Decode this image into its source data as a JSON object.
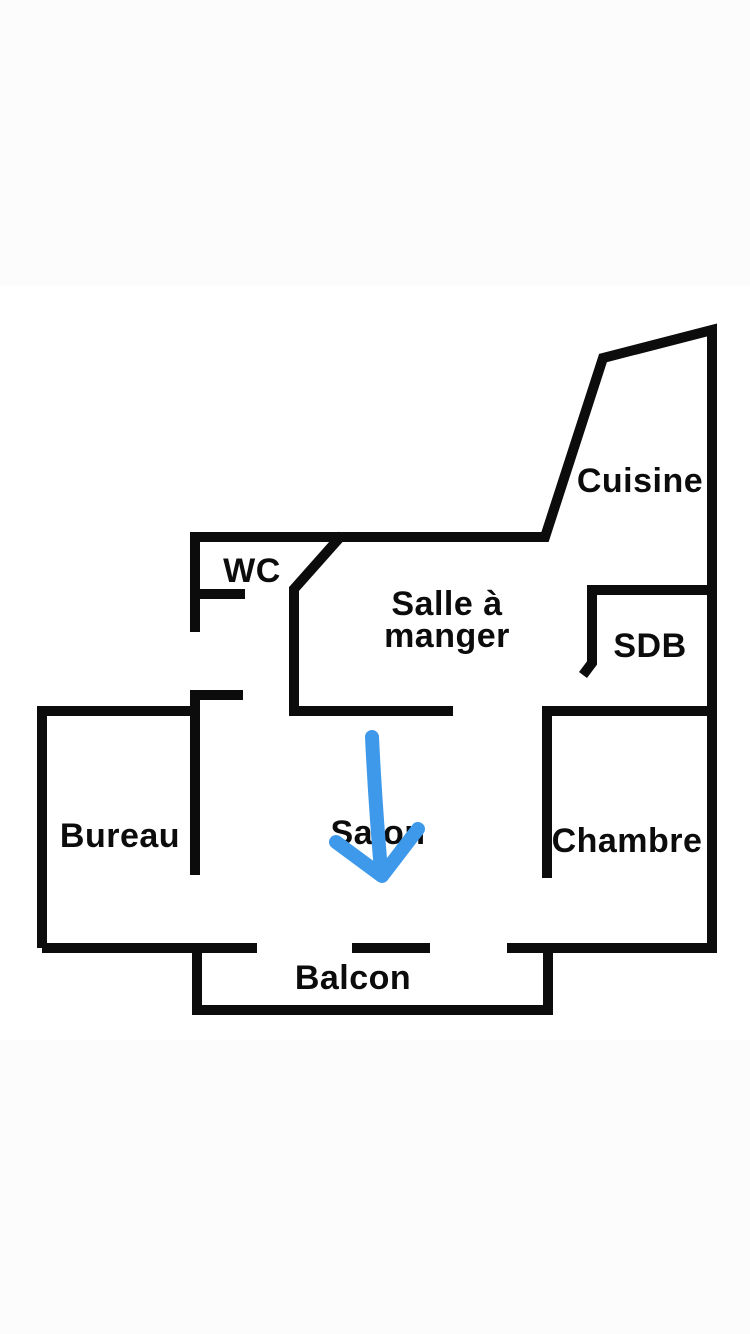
{
  "colors": {
    "wall": "#0c0c0c",
    "text": "#0c0c0c",
    "arrow": "#3e99ea",
    "background": "#ffffff",
    "page_margin": "#fcfcfd"
  },
  "floor_plan": {
    "type": "apartment-floor-plan",
    "rooms": {
      "cuisine": {
        "label": "Cuisine"
      },
      "wc": {
        "label": "WC"
      },
      "salle_a_manger": {
        "label": "Salle à manger",
        "line1": "Salle à",
        "line2": "manger"
      },
      "sdb": {
        "label": "SDB"
      },
      "bureau": {
        "label": "Bureau"
      },
      "salon": {
        "label": "Salon"
      },
      "chambre": {
        "label": "Chambre"
      },
      "balcon": {
        "label": "Balcon"
      }
    },
    "annotation": {
      "type": "hand-drawn-arrow",
      "direction": "down",
      "target_room": "Salon"
    }
  }
}
